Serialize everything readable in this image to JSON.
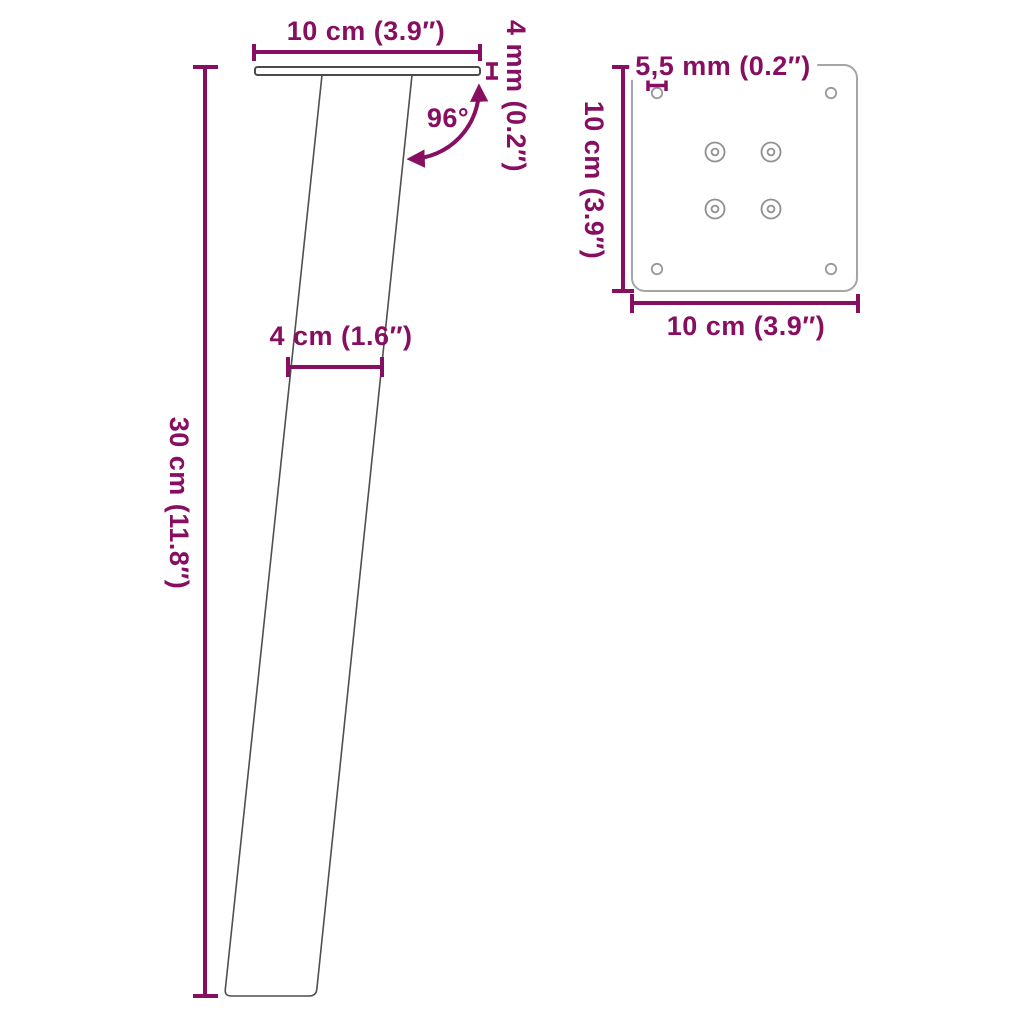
{
  "diagram_title": "table-leg-dimension-diagram",
  "accent_color": "#870E61",
  "side_view": {
    "description": "slanted table leg with top mounting plate, side view",
    "top_width_label": "10 cm (3.9″)",
    "plate_thickness_label": "4 mm (0.2″)",
    "angle_label": "96°",
    "leg_width_label": "4 cm (1.6″)",
    "leg_height_label": "30 cm (11.8″)"
  },
  "top_view": {
    "description": "mounting plate top view with 4 corner holes and 4 screw holes",
    "hole_diameter_label": "5,5 mm (0.2″)",
    "plate_height_label": "10 cm (3.9″)",
    "plate_width_label": "10 cm (3.9″)"
  }
}
